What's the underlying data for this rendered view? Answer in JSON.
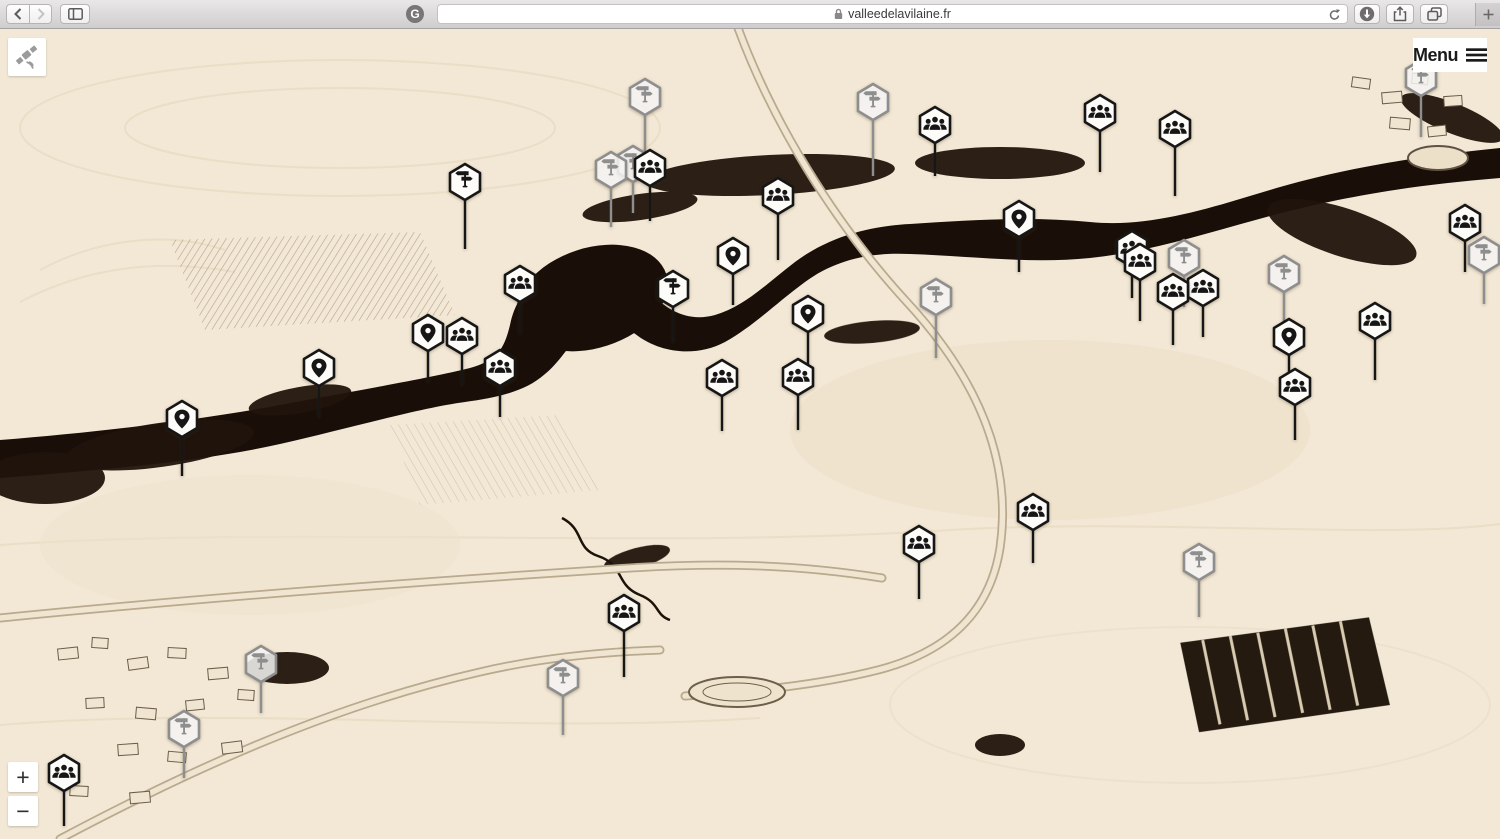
{
  "browser_chrome": {
    "url": "valleedelavilaine.fr",
    "url_secure": true,
    "extension_badge": "G",
    "icons": {
      "back": "chevron-left",
      "forward": "chevron-right",
      "sidebar": "split-pane",
      "lock": "padlock",
      "reload": "reload-arrow",
      "downloads": "download-circle",
      "share": "share-arrow-box",
      "tabs": "overlapping-squares",
      "new_tab": "plus"
    }
  },
  "page": {
    "site_logo_icon": "satellite",
    "menu": {
      "label": "Menu",
      "icon": "hamburger"
    },
    "zoom": {
      "in_label": "+",
      "out_label": "−"
    },
    "marker_types": {
      "pin": "location-pin",
      "group": "people-group",
      "signpost": "direction-signpost"
    },
    "colors": {
      "paper": "#f2e8d5",
      "ink": "#190f08",
      "active_marker": "#161616",
      "muted_marker": "#8e8e8e",
      "active_fill": "#fdfcf9",
      "muted_fill": "rgba(255,255,255,0.82)"
    }
  },
  "markers": [
    {
      "x": 645,
      "y": 97,
      "type": "signpost",
      "state": "muted",
      "stem": 42
    },
    {
      "x": 873,
      "y": 102,
      "type": "signpost",
      "state": "muted",
      "stem": 55
    },
    {
      "x": 1421,
      "y": 78,
      "type": "signpost",
      "state": "muted",
      "stem": 40
    },
    {
      "x": 1100,
      "y": 113,
      "type": "group",
      "state": "active",
      "stem": 40
    },
    {
      "x": 935,
      "y": 125,
      "type": "group",
      "state": "active",
      "stem": 32
    },
    {
      "x": 1175,
      "y": 129,
      "type": "group",
      "state": "active",
      "stem": 48
    },
    {
      "x": 633,
      "y": 164,
      "type": "signpost",
      "state": "muted",
      "stem": 30
    },
    {
      "x": 611,
      "y": 170,
      "type": "signpost",
      "state": "muted",
      "stem": 38
    },
    {
      "x": 650,
      "y": 168,
      "type": "group",
      "state": "active",
      "stem": 34
    },
    {
      "x": 465,
      "y": 182,
      "type": "signpost",
      "state": "active",
      "stem": 48
    },
    {
      "x": 778,
      "y": 196,
      "type": "group",
      "state": "active",
      "stem": 45
    },
    {
      "x": 1019,
      "y": 219,
      "type": "pin",
      "state": "active",
      "stem": 34
    },
    {
      "x": 1465,
      "y": 223,
      "type": "group",
      "state": "active",
      "stem": 30
    },
    {
      "x": 1484,
      "y": 255,
      "type": "signpost",
      "state": "muted",
      "stem": 30
    },
    {
      "x": 1132,
      "y": 249,
      "type": "group",
      "state": "active",
      "stem": 30
    },
    {
      "x": 733,
      "y": 256,
      "type": "pin",
      "state": "active",
      "stem": 30
    },
    {
      "x": 1184,
      "y": 258,
      "type": "signpost",
      "state": "muted",
      "stem": 30
    },
    {
      "x": 1140,
      "y": 262,
      "type": "group",
      "state": "active",
      "stem": 40
    },
    {
      "x": 1284,
      "y": 274,
      "type": "signpost",
      "state": "muted",
      "stem": 30
    },
    {
      "x": 520,
      "y": 284,
      "type": "group",
      "state": "active",
      "stem": 30
    },
    {
      "x": 1203,
      "y": 288,
      "type": "group",
      "state": "active",
      "stem": 30
    },
    {
      "x": 673,
      "y": 289,
      "type": "signpost",
      "state": "active",
      "stem": 34
    },
    {
      "x": 1173,
      "y": 292,
      "type": "group",
      "state": "active",
      "stem": 34
    },
    {
      "x": 936,
      "y": 297,
      "type": "signpost",
      "state": "muted",
      "stem": 42
    },
    {
      "x": 808,
      "y": 314,
      "type": "pin",
      "state": "active",
      "stem": 34
    },
    {
      "x": 1375,
      "y": 321,
      "type": "group",
      "state": "active",
      "stem": 40
    },
    {
      "x": 428,
      "y": 333,
      "type": "pin",
      "state": "active",
      "stem": 30
    },
    {
      "x": 462,
      "y": 336,
      "type": "group",
      "state": "active",
      "stem": 30
    },
    {
      "x": 1289,
      "y": 337,
      "type": "pin",
      "state": "active",
      "stem": 30
    },
    {
      "x": 319,
      "y": 368,
      "type": "pin",
      "state": "active",
      "stem": 30
    },
    {
      "x": 500,
      "y": 368,
      "type": "group",
      "state": "active",
      "stem": 30
    },
    {
      "x": 722,
      "y": 378,
      "type": "group",
      "state": "active",
      "stem": 34
    },
    {
      "x": 798,
      "y": 377,
      "type": "group",
      "state": "active",
      "stem": 34
    },
    {
      "x": 1295,
      "y": 387,
      "type": "group",
      "state": "active",
      "stem": 34
    },
    {
      "x": 182,
      "y": 419,
      "type": "pin",
      "state": "active",
      "stem": 38
    },
    {
      "x": 1033,
      "y": 512,
      "type": "group",
      "state": "active",
      "stem": 32
    },
    {
      "x": 919,
      "y": 544,
      "type": "group",
      "state": "active",
      "stem": 36
    },
    {
      "x": 1199,
      "y": 562,
      "type": "signpost",
      "state": "muted",
      "stem": 36
    },
    {
      "x": 624,
      "y": 613,
      "type": "group",
      "state": "active",
      "stem": 45
    },
    {
      "x": 261,
      "y": 664,
      "type": "signpost",
      "state": "muted",
      "stem": 30
    },
    {
      "x": 563,
      "y": 678,
      "type": "signpost",
      "state": "muted",
      "stem": 38
    },
    {
      "x": 184,
      "y": 729,
      "type": "signpost",
      "state": "muted",
      "stem": 30
    },
    {
      "x": 64,
      "y": 773,
      "type": "group",
      "state": "active",
      "stem": 34
    }
  ]
}
